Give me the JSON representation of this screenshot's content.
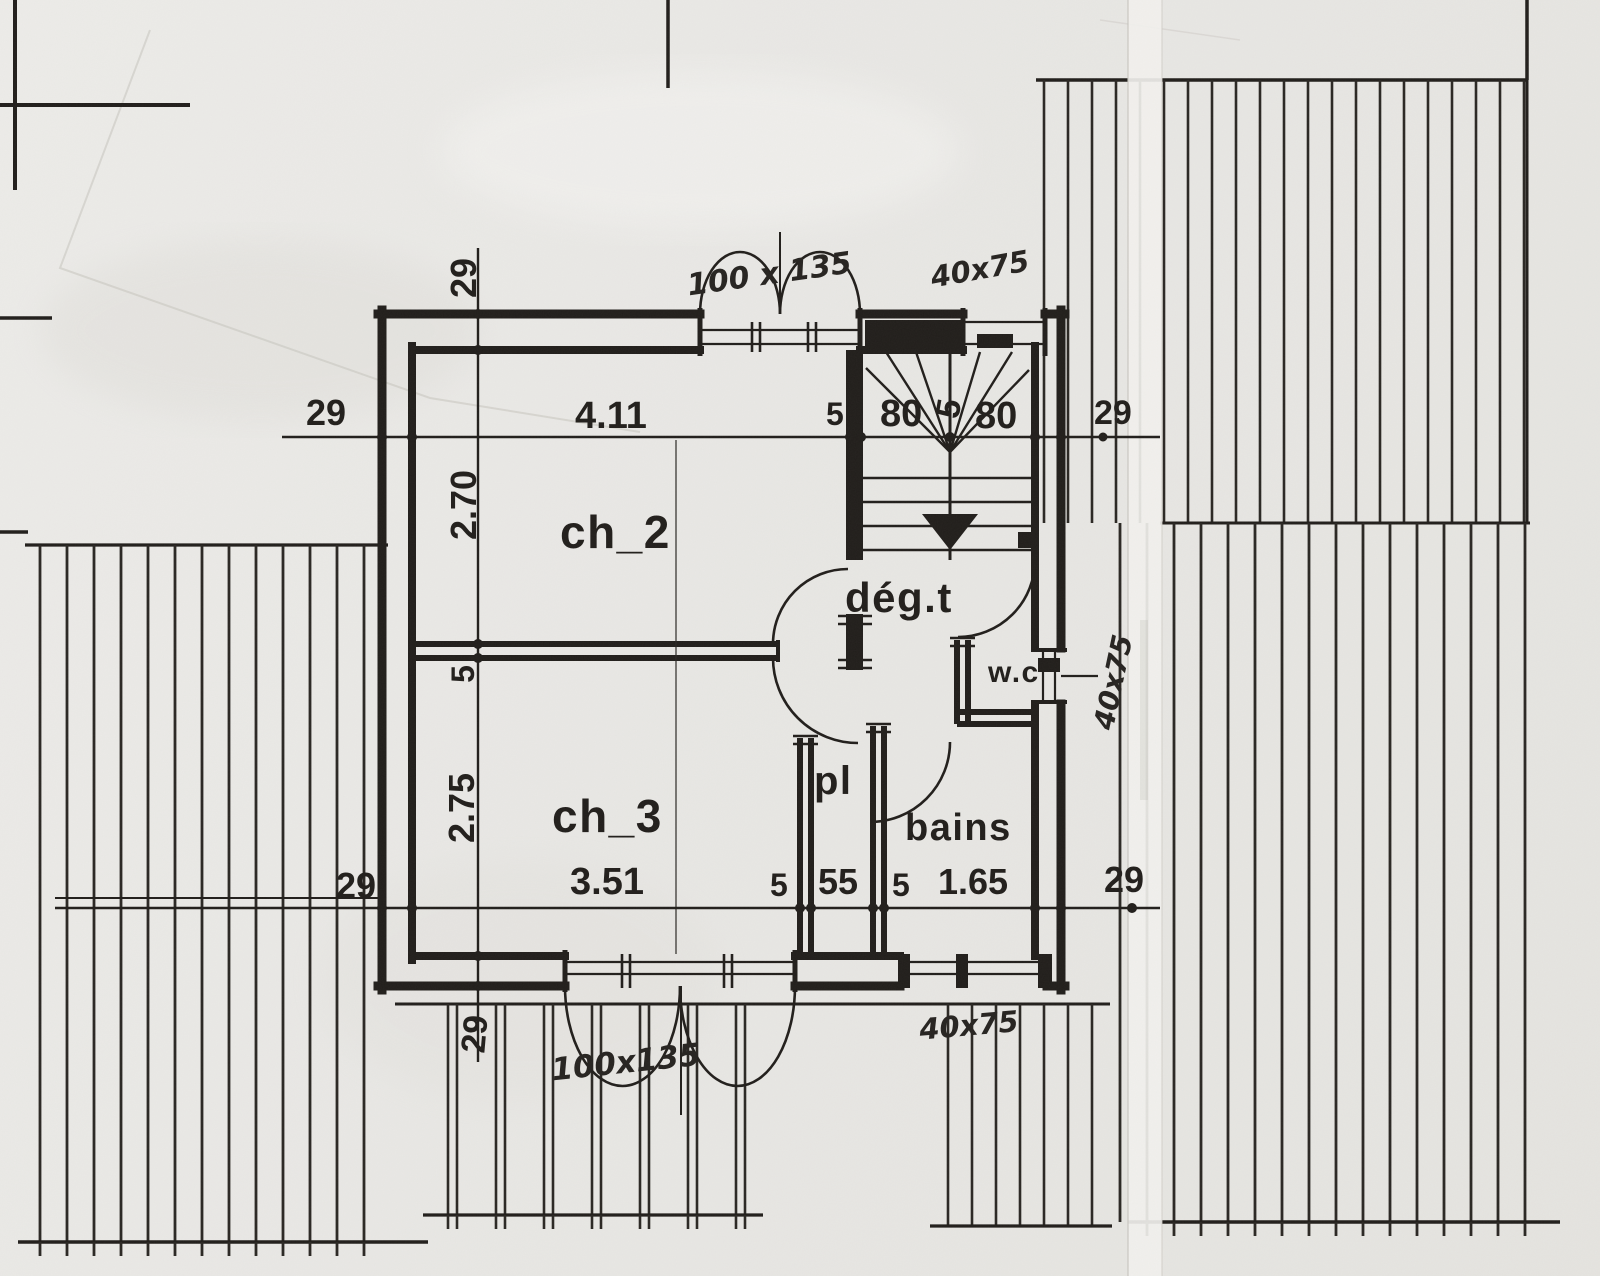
{
  "plan_type": "floor-plan-scan",
  "colors": {
    "ink": "#211e1b",
    "paper": "#e9e8e5",
    "crease": "#f2f1ee"
  },
  "rooms": {
    "ch2": "ch_2",
    "ch3": "ch_3",
    "degagement": "dég.t",
    "wc": "w.c",
    "placard": "pl",
    "bains": "bains"
  },
  "dims": {
    "top": {
      "wall_left": "29",
      "ch2_width": "4.11",
      "s5a": "5",
      "stair_a": "80",
      "s5b": "5",
      "stair_b": "80",
      "wall_right": "29"
    },
    "left": {
      "wall_top": "29",
      "ch2_height": "2.70",
      "partition": "5",
      "ch3_height": "2.75",
      "wall_bottom": "29"
    },
    "bottom": {
      "balcony": "29",
      "ch3_width": "3.51",
      "s5a": "5",
      "placard_width": "55",
      "s5b": "5",
      "bains_width": "1.65",
      "right": "29"
    }
  },
  "annotations": {
    "door_top": "100 x 135",
    "window_top": "40x75",
    "window_right": "40x75",
    "door_bottom": "100x135",
    "window_bottom": "40x75"
  }
}
